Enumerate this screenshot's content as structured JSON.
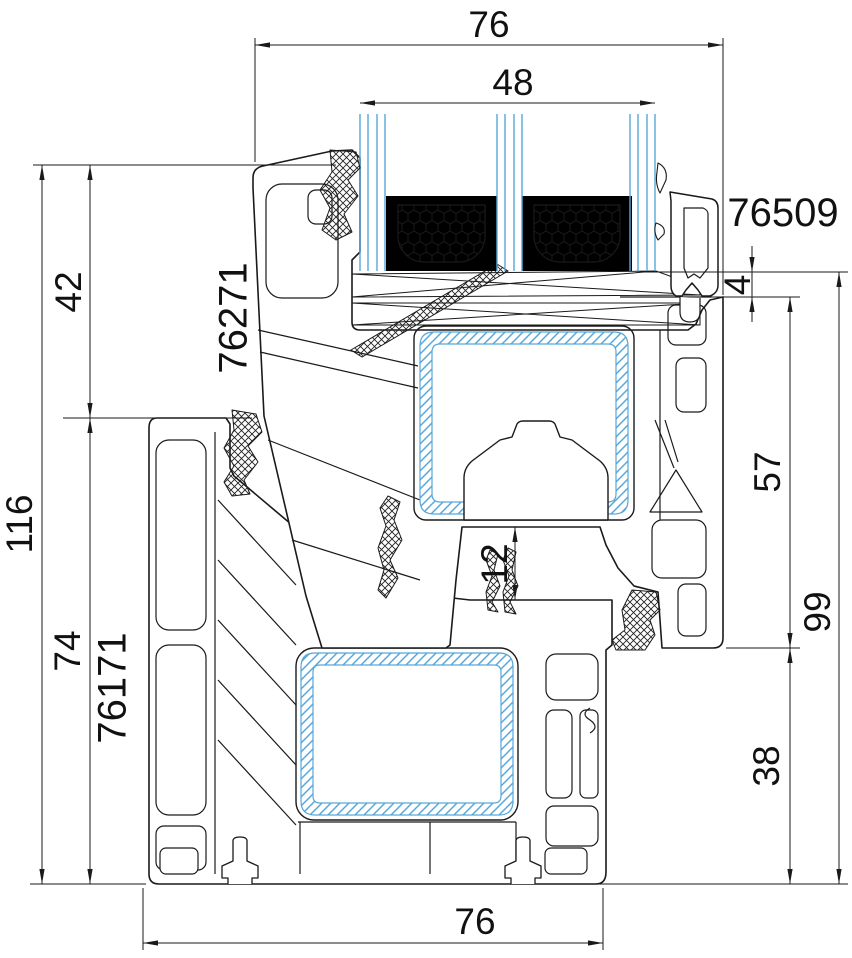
{
  "drawing": {
    "type": "technical-cross-section",
    "subject": "PVC window profile bottom section with triple glazing",
    "profiles": {
      "sash": "76271",
      "frame": "76171",
      "glazing_bead": "76509"
    },
    "dimensions_mm": {
      "sash_overall_width": "76",
      "glazing_unit_thickness": "48",
      "overall_height": "116",
      "sash_face_height": "42",
      "frame_height": "74",
      "glass_edge_clearance": "4",
      "sash_profile_height": "57",
      "rebate_total_height": "99",
      "frame_lower_height": "38",
      "hardware_gap": "12",
      "frame_overall_width": "76"
    },
    "colors": {
      "line": "#1a1a1a",
      "accent_blue": "#57a7d9",
      "seal_black": "#000000",
      "background": "#ffffff"
    }
  }
}
